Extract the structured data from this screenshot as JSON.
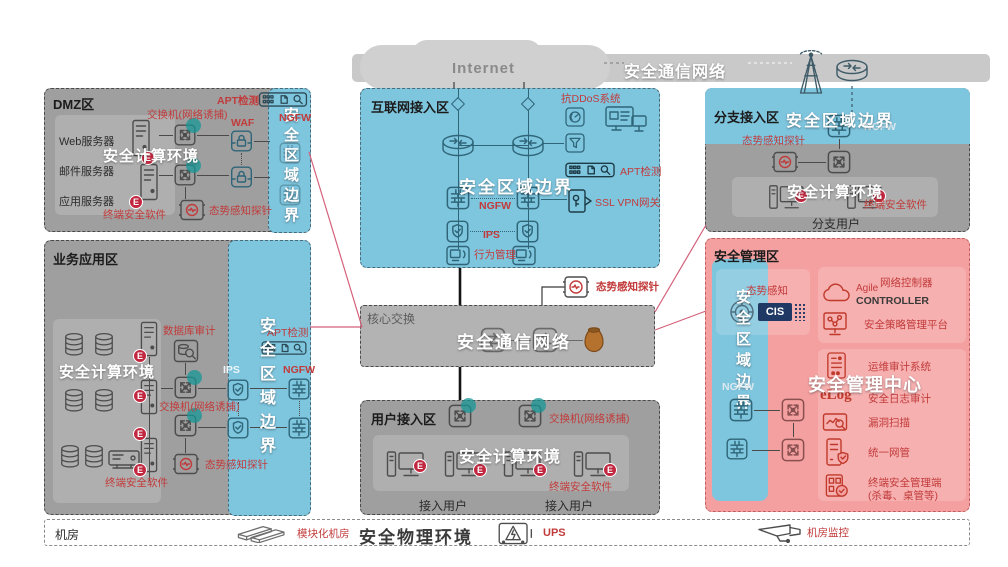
{
  "banner": {
    "internet": "Internet",
    "secure_comm": "安全通信网络"
  },
  "badge": {
    "e": "E"
  },
  "zones": {
    "dmz": {
      "title": "DMZ区",
      "apt": "APT检测",
      "switch_trap": "交换机(网络诱捕)",
      "waf": "WAF",
      "ngfw": "NGFW",
      "server1": "Web服务器",
      "server2": "邮件服务器",
      "server3": "应用服务器",
      "compute_env": "安全计算环境",
      "endpoint": "终端安全软件",
      "probe": "态势感知探针",
      "boundary": "安全区域边界"
    },
    "biz": {
      "title": "业务应用区",
      "db_audit": "数据库审计",
      "ips": "IPS",
      "apt": "APT检测",
      "ngfw": "NGFW",
      "switch_trap": "交换机(网络诱捕)",
      "probe": "态势感知探针",
      "endpoint": "终端安全软件",
      "compute_env": "安全计算环境",
      "boundary": "安全区域边界"
    },
    "inet": {
      "title": "互联网接入区",
      "antiddos": "抗DDoS系统",
      "boundary": "安全区域边界",
      "ngfw": "NGFW",
      "apt": "APT检测",
      "sslvpn": "SSL VPN网关",
      "ips": "IPS",
      "behavior": "行为管理"
    },
    "core": {
      "title": "核心交换",
      "secure_comm": "安全通信网络",
      "probe": "态势感知探针"
    },
    "user": {
      "title": "用户接入区",
      "switch_trap": "交换机(网络诱捕)",
      "compute_env": "安全计算环境",
      "endpoint": "终端安全软件",
      "user1": "接入用户",
      "user2": "接入用户"
    },
    "branch": {
      "title": "分支接入区",
      "boundary": "安全区域边界",
      "ngfw": "NGFW",
      "probe": "态势感知探针",
      "compute_env": "安全计算环境",
      "endpoint": "终端安全软件",
      "users": "分支用户"
    },
    "mgmt": {
      "title": "安全管理区",
      "boundary": "安全区域边界",
      "ngfw": "NGFW",
      "situation": "态势感知",
      "cis": "CIS",
      "agile": "Agile",
      "controller": "CONTROLLER",
      "net_controller": "网络控制器",
      "policy_platform": "安全策略管理平台",
      "ops_audit": "运维审计系统",
      "elog": "eLog",
      "log_audit": "安全日志审计",
      "vuln_scan": "漏洞扫描",
      "unified_nms": "统一网管",
      "endpoint_mgmt": "终端安全管理端",
      "endpoint_mgmt2": "(杀毒、桌管等)",
      "center": "安全管理中心"
    },
    "phys": {
      "title": "机房",
      "modular": "模块化机房",
      "env": "安全物理环境",
      "ups": "UPS",
      "monitor": "机房监控"
    }
  },
  "colors": {
    "zone_blue": "#7ec5de",
    "zone_gray": "#9f9f9f",
    "zone_pink": "#f5a0a0",
    "banner_gray": "#c9c9c9",
    "accent_red": "#c23b3b",
    "icon_slate": "#2f6578",
    "icon_dark": "#4d4d4d",
    "badge_red": "#c22740"
  }
}
